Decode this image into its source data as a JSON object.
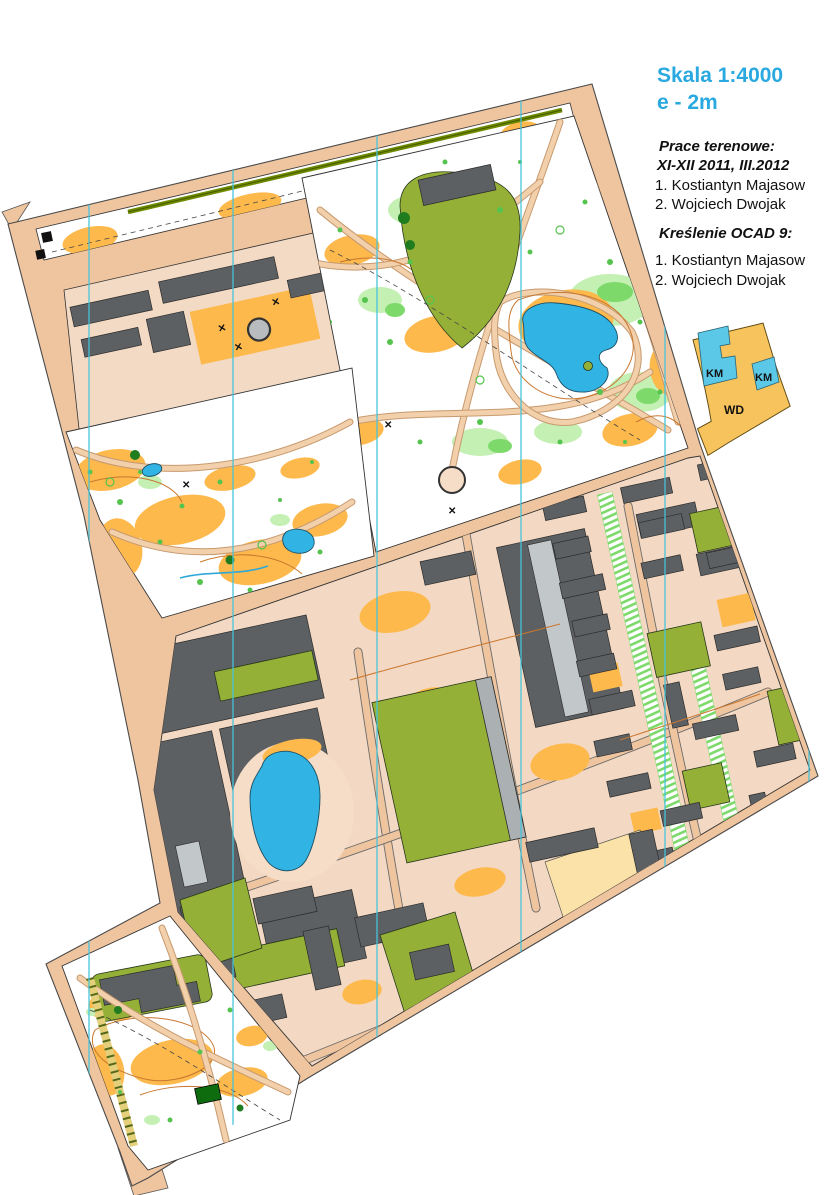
{
  "header": {
    "scale_label": "Skala 1:4000",
    "contour_label": "e - 2m"
  },
  "credits": {
    "fieldwork_heading": "Prace terenowe:",
    "fieldwork_period": "XI-XII 2011, III.2012",
    "fieldwork_authors": [
      "1. Kostiantyn Majasow",
      "2. Wojciech Dwojak"
    ],
    "drafting_heading": "Kreślenie OCAD 9:",
    "drafting_authors": [
      "1. Kostiantyn Majasow",
      "2. Wojciech Dwojak"
    ]
  },
  "coverage_diagram": {
    "region_labels": [
      "KM",
      "KM",
      "WD"
    ]
  },
  "colors": {
    "accent_text_cyan": "#29A9E0",
    "open_land_orange": "#FDB94C",
    "olive_green": "#95B037",
    "vegetation_green": "#7CD96A",
    "building_gray": "#5D6063",
    "water_blue": "#31B3E3",
    "road_tan": "#EFC5A0",
    "paved_beige": "#F3D9C3",
    "contour_brown": "#C8772F",
    "north_line_cyan": "#45C3DC",
    "diagram_orange": "#F7C35C",
    "diagram_cyan": "#5BC8E8"
  }
}
